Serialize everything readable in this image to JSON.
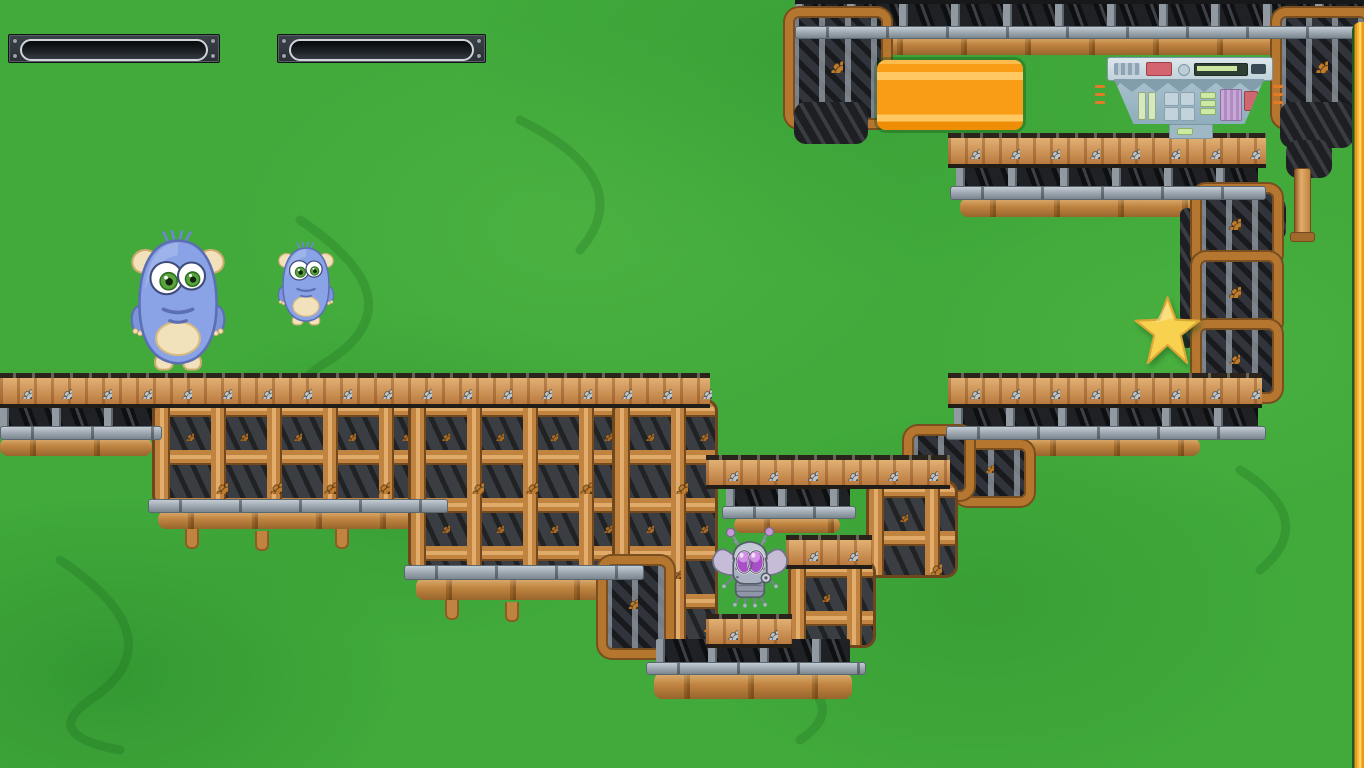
{
  "scene": {
    "type": "2d steampunk platformer game level",
    "visible_text": "",
    "background": "green painted canyon backdrop with steampunk gear-and-pipe platforms"
  },
  "hud": {
    "meters": [
      {
        "name": "meter-1",
        "fill_percent": 0,
        "state": "empty"
      },
      {
        "name": "meter-2",
        "fill_percent": 0,
        "state": "empty"
      }
    ]
  },
  "entities": {
    "monster_large": {
      "label": "large blue furry monster",
      "pose": "standing on left platform"
    },
    "monster_small": {
      "label": "small blue furry monster",
      "pose": "in mid-air above left platform"
    },
    "robot_fly": {
      "label": "robot fly with purple eyes",
      "pose": "standing on low center platform"
    },
    "star": {
      "label": "gold star collectible"
    },
    "orange_block": {
      "label": "orange striped block"
    },
    "machine": {
      "label": "blue-grey control machine with red and green lights"
    }
  },
  "colors": {
    "background_green": "#41aa3b",
    "copper_pipe": "#c08440",
    "plank_wood": "#c89053",
    "steel_beam": "#97a1aa",
    "gear_silver": "#bcc3c9",
    "gear_copper": "#c07c2e",
    "star_gold": "#f8d14e",
    "orange_block": "#f99d16",
    "wall_orange": "#ef9617",
    "wall_yellow": "#ffd75e",
    "monster_blue": "#89a3e6",
    "monster_cream": "#f2e2bc",
    "fly_eye_purple": "#c77de0",
    "hud_plate": "#2b3036"
  }
}
